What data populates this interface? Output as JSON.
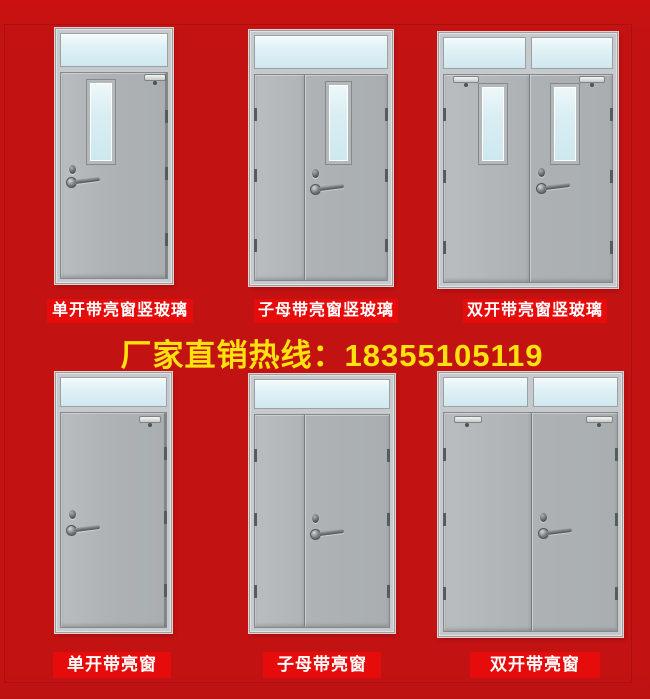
{
  "page": {
    "background_color": "#c31212",
    "label_background_color": "#e70c0c",
    "label_text_color": "#ffffff",
    "hotline_text": "厂家直销热线：18355105119",
    "hotline_color": "#ffe20d"
  },
  "colors": {
    "door_frame": "#c7cacc",
    "door_leaf": "#aeb2b4",
    "glass": "#d5ecf2",
    "hardware": "#4e5456"
  },
  "doors": [
    {
      "name": "single-leaf-transom-vision-glass",
      "label": "单开带亮窗竖玻璃"
    },
    {
      "name": "mother-child-transom-vision-glass",
      "label": "子母带亮窗竖玻璃"
    },
    {
      "name": "double-leaf-transom-vision-glass",
      "label": "双开带亮窗竖玻璃"
    },
    {
      "name": "single-leaf-transom",
      "label": "单开带亮窗"
    },
    {
      "name": "mother-child-transom",
      "label": "子母带亮窗"
    },
    {
      "name": "double-leaf-transom",
      "label": "双开带亮窗"
    }
  ]
}
